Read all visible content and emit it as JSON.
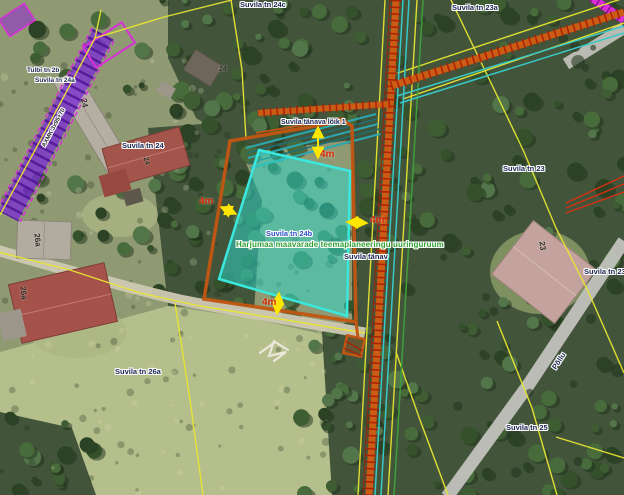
{
  "map": {
    "street_labels": {
      "suvila_tn_24c": "Suvila tn 24c",
      "suvila_tn_23a": "Suvila tn 23a",
      "tulbi_tn_2b": "Tulbi tn 2b",
      "suvila_tn_24a": "Suvila tn 24a",
      "suvila_tn_24": "Suvila tn 24",
      "suvila_tn_23": "Suvila tn 23",
      "suvila_tn_23b": "Suvila tn 23b",
      "suvila_tn_24b": "Suvila tn 24b",
      "suvila_tn_25": "Suvila tn 25",
      "suvila_tn_26a": "Suvila tn 26a",
      "suvila_tanava_loik": "Suvila tänava lõik 1",
      "suvila_tanav": "Suvila tänav",
      "pollu": "Põllu"
    },
    "house_numbers": {
      "n24_long_building": "24",
      "n24_shed": "24",
      "n24_house": "24",
      "n23_house": "23",
      "n26a_house": "26a",
      "n26a_outbuilding": "26a"
    },
    "annotations": {
      "survey_area_note": "Harjumaa maavarade teemaplaneeringu uuringuruum",
      "cable_label": "AXMK 3x95+70",
      "setback_top": "4m",
      "setback_left": "4m",
      "setback_right": "4m",
      "setback_bottom": "4m"
    }
  },
  "theme": {
    "--parcel-cyan": "#3ae8de",
    "--parcel-cyan-fill": "rgba(46,216,204,0.52)",
    "--boundary-orange": "#c25612",
    "--cadastral-yellow": "#e8e532",
    "--utility-orange": "#cc5c14",
    "--utility-hatch-red": "#a81e06",
    "--utility-cyan": "#38c8c8",
    "--utility-green": "#3f9e3c",
    "--protection-purple": "#7c2ed2",
    "--protection-magenta": "#da2ed8",
    "--measure-red": "#d42600",
    "--label-navy": "#1b2550",
    "--label-blue": "#2f4ec8",
    "--note-green": "#2fa032",
    "--arrow-yellow": "#ffe600"
  }
}
